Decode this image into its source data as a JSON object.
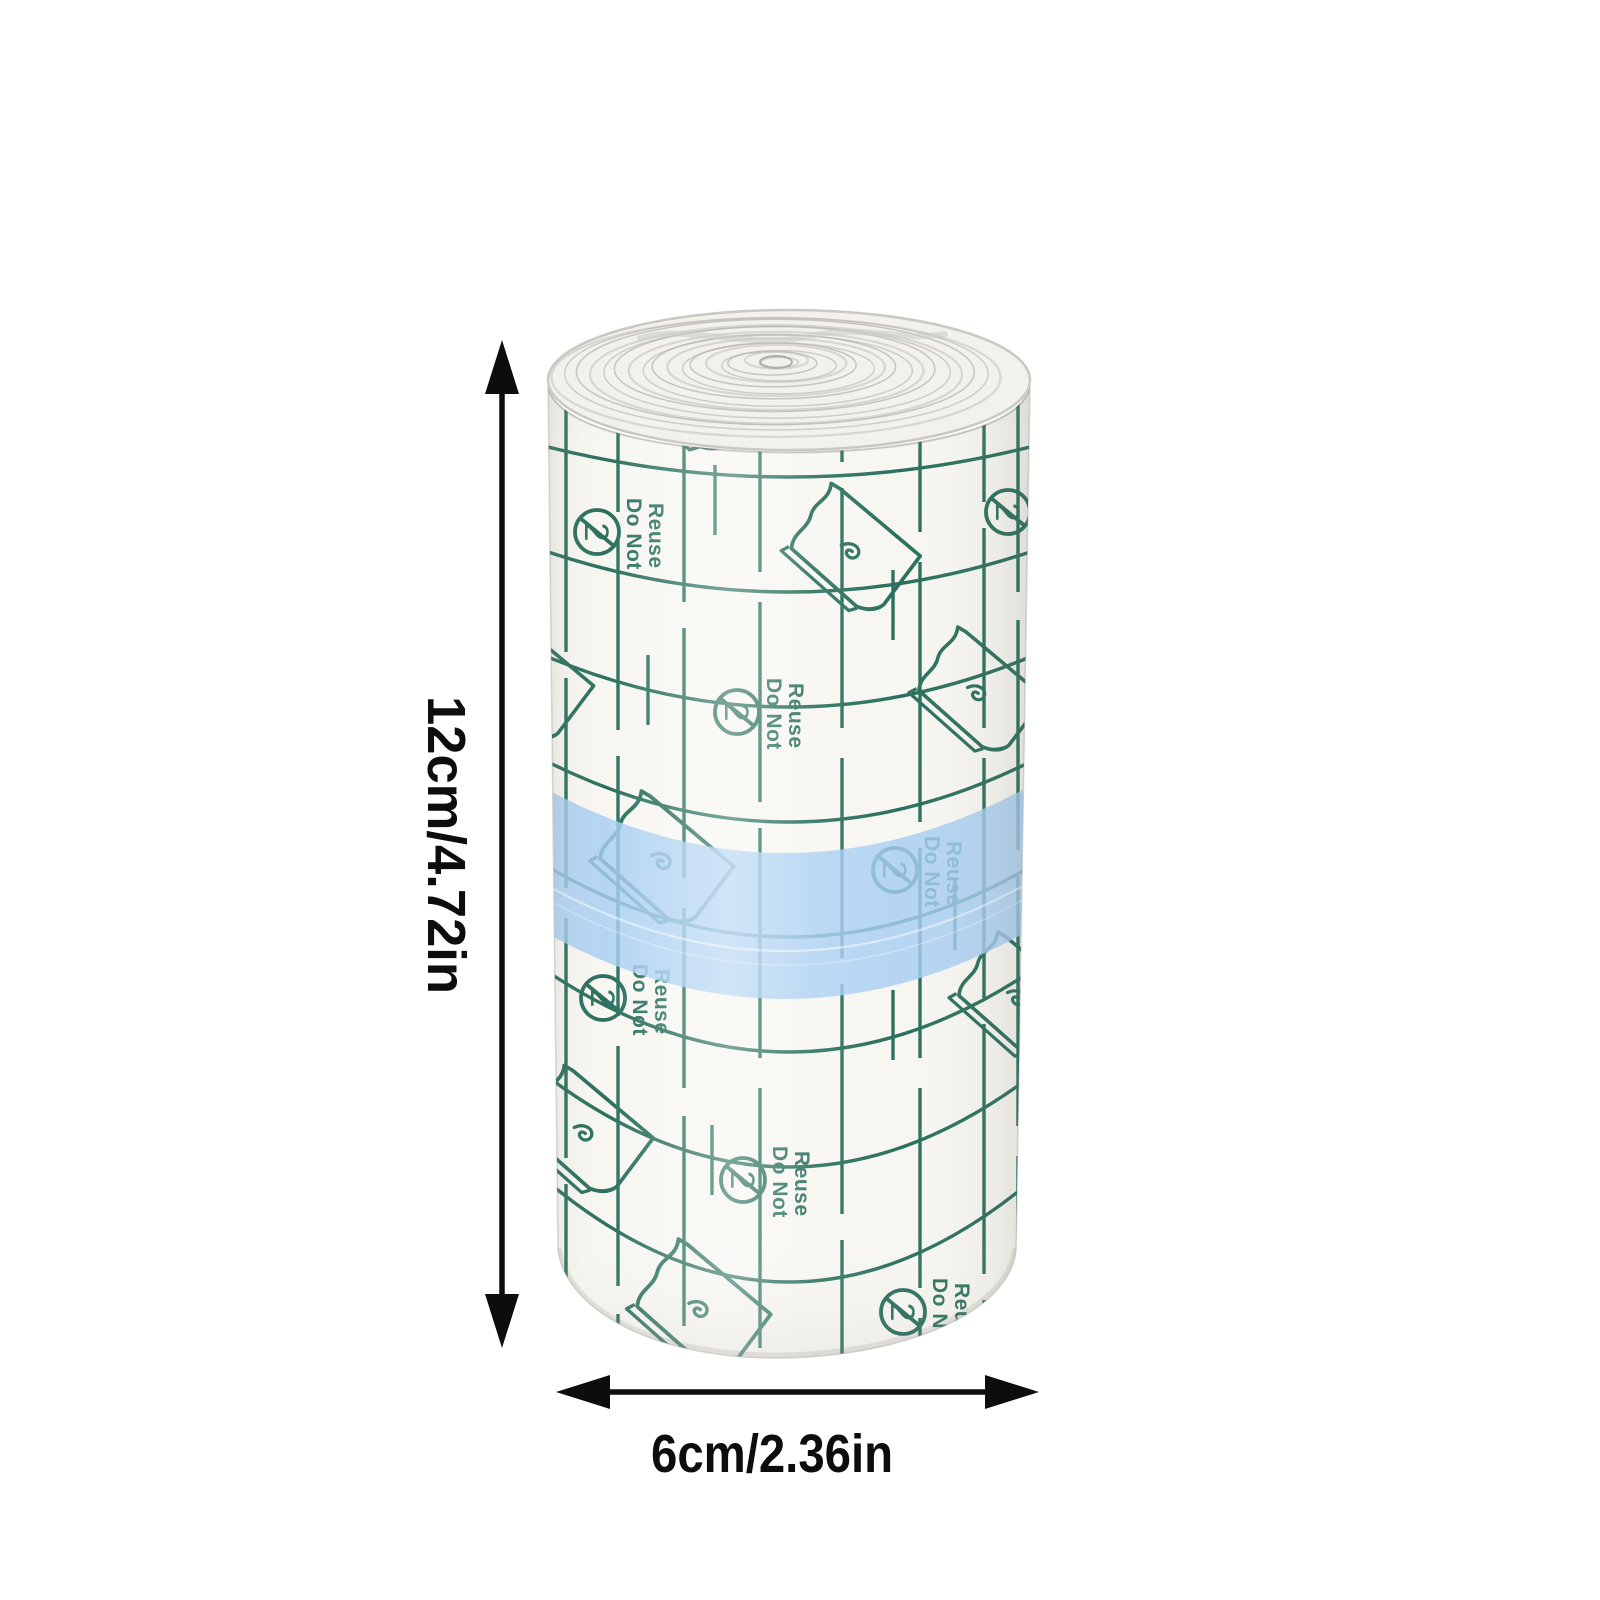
{
  "annotations": {
    "height_label": "12cm/4.72in",
    "width_label": "6cm/2.36in",
    "arrow_color": "#0d0d0d",
    "text_color": "#0d0d0d"
  },
  "product": {
    "name": "transparent film dressing roll",
    "print": {
      "do_not": "Do Not",
      "reuse": "Reuse",
      "digit": "2",
      "corner_mark": "DR"
    },
    "icons": {
      "do_not_reuse": "circle-crossed-2-icon",
      "peel_sheet": "film-sheet-curled-corner-icon",
      "height_arrow": "vertical-double-arrow",
      "width_arrow": "horizontal-double-arrow"
    },
    "colors": {
      "grid_green": "#2b705e",
      "band_blue": "#a6cdf1",
      "film_white": "#f7f6f1",
      "spiral_gray": "#b6b5af"
    }
  }
}
